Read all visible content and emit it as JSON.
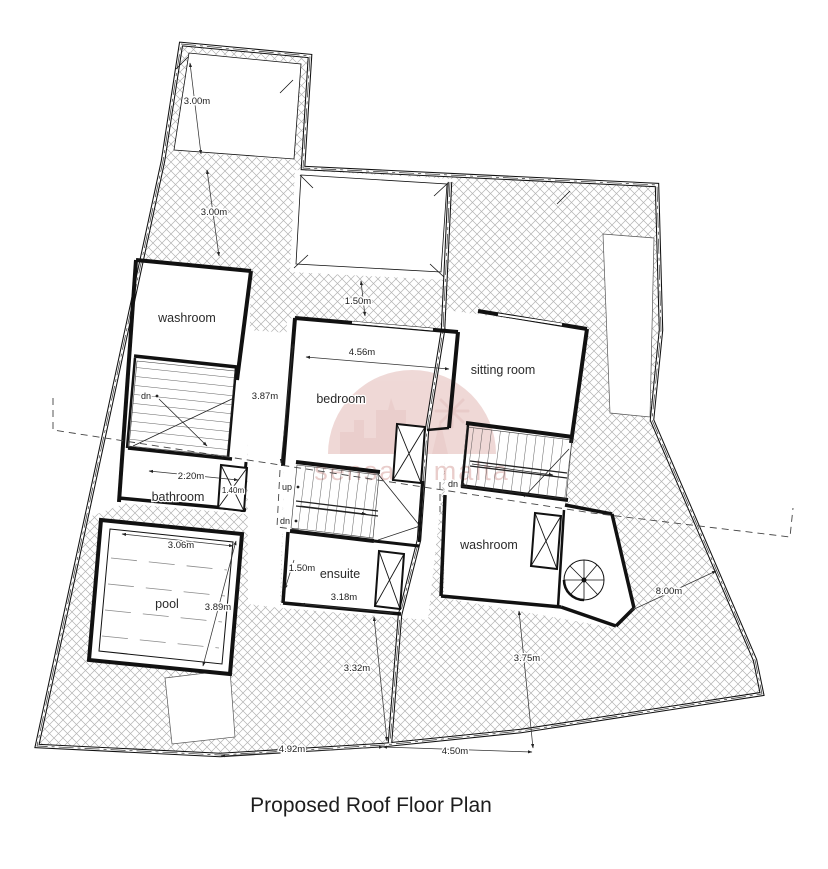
{
  "title": "Proposed Roof Floor Plan",
  "watermark": {
    "text": "sensara malta"
  },
  "rooms": {
    "washroom_left": "washroom",
    "bathroom": "bathroom",
    "pool": "pool",
    "bedroom": "bedroom",
    "ensuite": "ensuite",
    "sitting_room": "sitting room",
    "washroom_right": "washroom"
  },
  "stairs": {
    "dn": "dn",
    "up": "up"
  },
  "dimensions": {
    "top_roof": "3.00m",
    "top_terrace": "3.00m",
    "courtyard_gap": "1.50m",
    "bedroom_width": "4.56m",
    "bedroom_depth": "3.87m",
    "stair_width": "2.20m",
    "duct_width": "1.40m",
    "ensuite_height": "1.50m",
    "ensuite_width": "3.18m",
    "pool_width": "3.06m",
    "pool_length": "3.89m",
    "rear_left": "3.32m",
    "rear_right": "3.75m",
    "side_right": "8.00m",
    "bottom_left": "4.92m",
    "bottom_right": "4.50m"
  }
}
